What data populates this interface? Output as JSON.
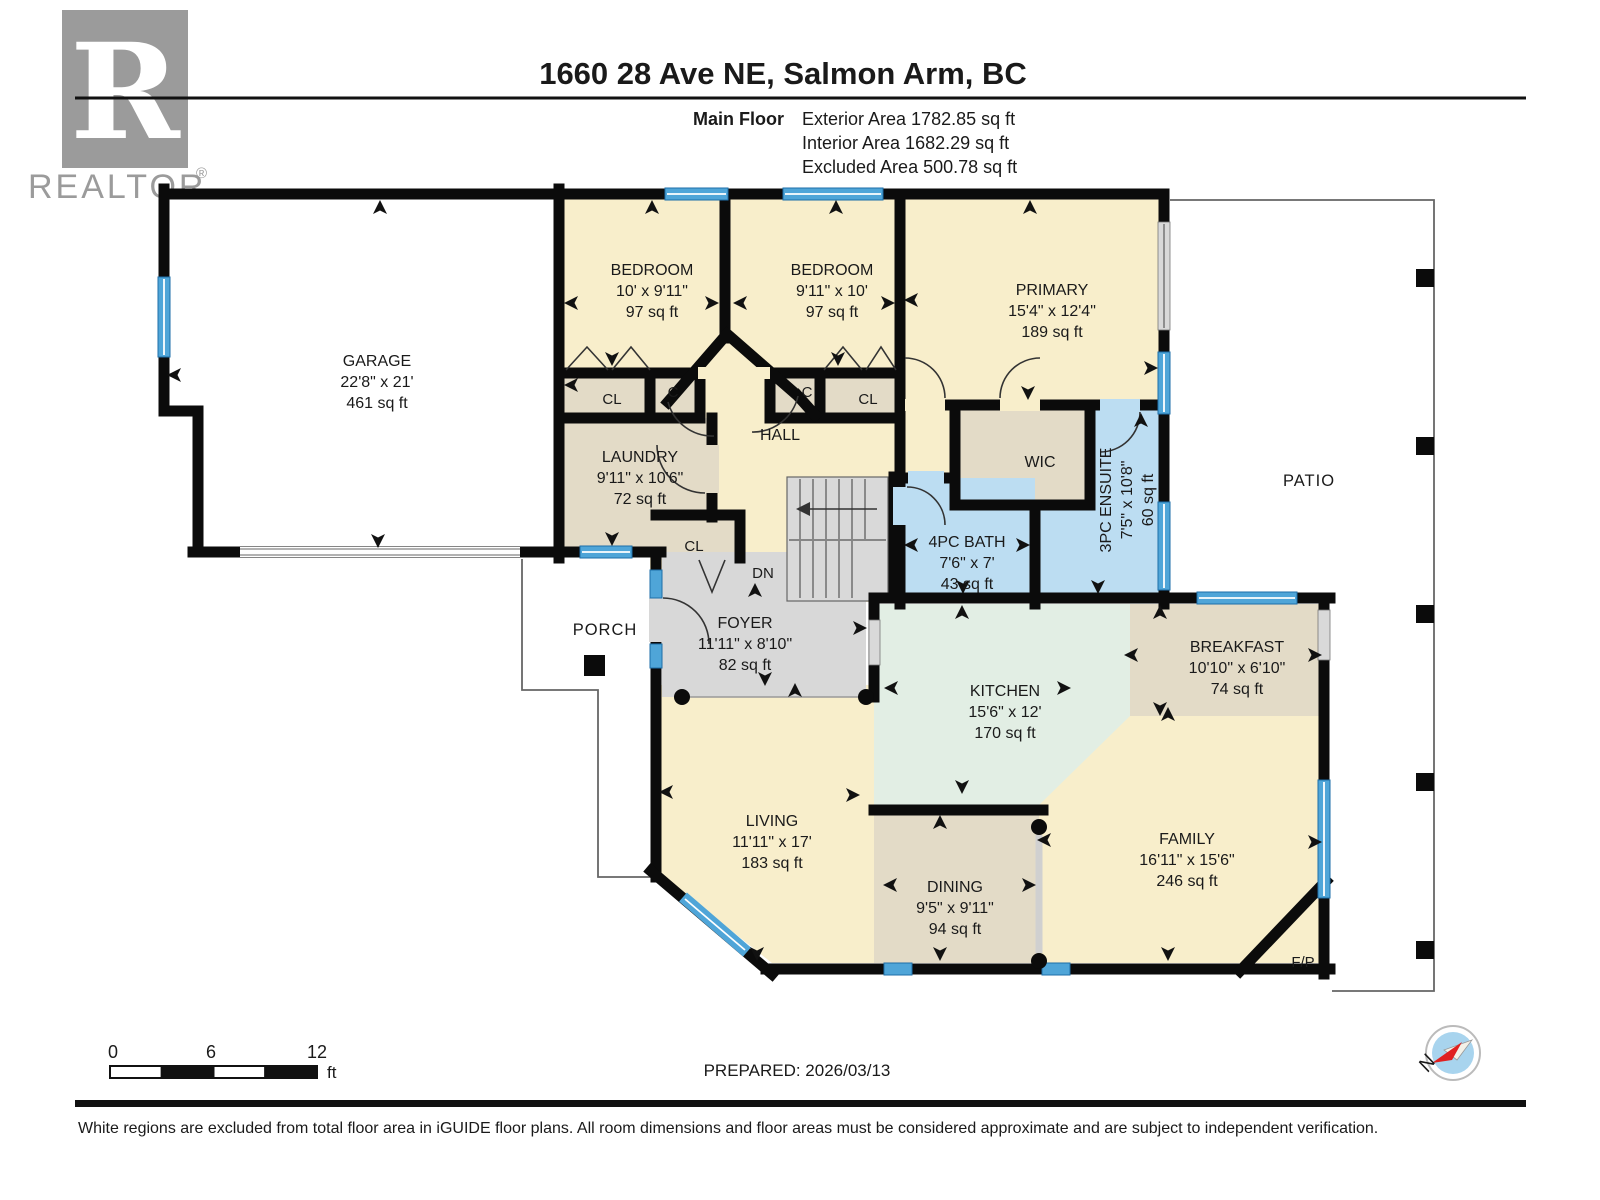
{
  "header": {
    "logo": {
      "letter": "R",
      "word": "REALTOR",
      "reg": "®"
    },
    "title": "1660 28 Ave NE, Salmon Arm, BC",
    "floor_label": "Main Floor",
    "area_lines": [
      "Exterior Area 1782.85 sq ft",
      "Interior Area 1682.29 sq ft",
      "Excluded Area 500.78 sq ft"
    ]
  },
  "rooms": [
    {
      "name": "GARAGE",
      "dims": "22'8\" x 21'",
      "area": "461 sq ft"
    },
    {
      "name": "BEDROOM",
      "dims": "10' x 9'11\"",
      "area": "97 sq ft"
    },
    {
      "name": "BEDROOM",
      "dims": "9'11\" x 10'",
      "area": "97 sq ft"
    },
    {
      "name": "PRIMARY",
      "dims": "15'4\" x 12'4\"",
      "area": "189 sq ft"
    },
    {
      "name": "LAUNDRY",
      "dims": "9'11\" x 10'6\"",
      "area": "72 sq ft"
    },
    {
      "name": "HALL"
    },
    {
      "name": "WIC"
    },
    {
      "name": "4PC BATH",
      "dims": "7'6\" x 7'",
      "area": "43 sq ft"
    },
    {
      "name": "3PC ENSUITE",
      "dims": "7'5\" x 10'8\"",
      "area": "60 sq ft"
    },
    {
      "name": "FOYER",
      "dims": "11'11\" x 8'10\"",
      "area": "82 sq ft"
    },
    {
      "name": "KITCHEN",
      "dims": "15'6\" x 12'",
      "area": "170 sq ft"
    },
    {
      "name": "BREAKFAST",
      "dims": "10'10\" x 6'10\"",
      "area": "74 sq ft"
    },
    {
      "name": "LIVING",
      "dims": "11'11\" x 17'",
      "area": "183 sq ft"
    },
    {
      "name": "DINING",
      "dims": "9'5\" x 9'11\"",
      "area": "94 sq ft"
    },
    {
      "name": "FAMILY",
      "dims": "16'11\" x 15'6\"",
      "area": "246 sq ft"
    },
    {
      "name": "PATIO"
    },
    {
      "name": "PORCH"
    }
  ],
  "misc": {
    "closet_label": "CL",
    "small_closet_label": "C",
    "stairs_label": "DN",
    "fireplace_label": "F/P"
  },
  "footer": {
    "scale": {
      "ticks": [
        "0",
        "6",
        "12"
      ],
      "unit": "ft"
    },
    "prepared": "PREPARED: 2026/03/13",
    "compass": {
      "north_label": "N"
    },
    "disclaimer": "White regions are excluded from total floor area in iGUIDE floor plans. All room dimensions and floor areas must be considered approximate and are subject to independent verification."
  },
  "colors": {
    "wall": "#0b0b0b",
    "window_blue": "#4fa5d8",
    "room_cream": "#f8eecb",
    "room_tan": "#e3dbc7",
    "room_blue": "#bcddf2",
    "room_mint": "#e2eee4",
    "room_gray": "#d8d8d8",
    "excluded_white": "#ffffff",
    "compass_red": "#e02020",
    "compass_blue": "#a8d4ee",
    "logo_gray": "#9b9b9b"
  }
}
